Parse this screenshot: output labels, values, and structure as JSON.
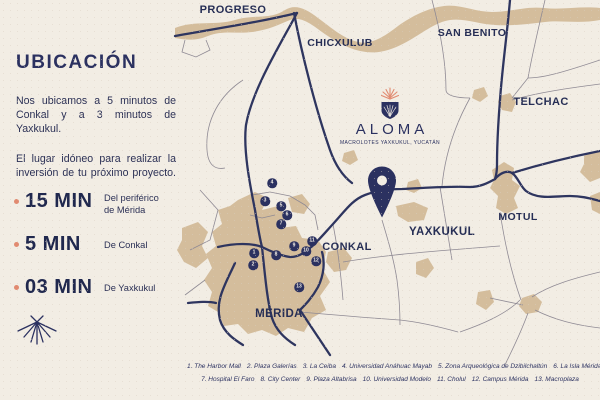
{
  "colors": {
    "background": "#f2ede4",
    "navy": "#2b3160",
    "land_tan": "#d4bd9c",
    "salmon": "#e18a70",
    "thin_road": "#8f8a94"
  },
  "sidebar": {
    "title": "UBICACIÓN",
    "paragraphs": [
      "Nos ubicamos a 5 minutos de Conkal y a 3 minutos de Yaxkukul.",
      "El lugar idóneo para realizar la inversión de tu próximo proyecto."
    ],
    "times": [
      {
        "value": "15 MIN",
        "caption": "Del periférico de Mérida"
      },
      {
        "value": "5 MIN",
        "caption": "De Conkal"
      },
      {
        "value": "03 MIN",
        "caption": "De Yaxkukul"
      }
    ]
  },
  "map": {
    "logo": {
      "name": "ALOMA",
      "tagline": "MACROLOTES YAXKUKUL, YUCATÁN"
    },
    "cities": [
      {
        "name": "PROGRESO",
        "x": 233,
        "y": 10,
        "fs": 11
      },
      {
        "name": "CHICXULUB",
        "x": 340,
        "y": 43,
        "fs": 10.5
      },
      {
        "name": "SAN BENITO",
        "x": 472,
        "y": 33,
        "fs": 10.5
      },
      {
        "name": "TELCHAC",
        "x": 541,
        "y": 102,
        "fs": 11
      },
      {
        "name": "MOTUL",
        "x": 518,
        "y": 217,
        "fs": 10.5
      },
      {
        "name": "CONKAL",
        "x": 347,
        "y": 247,
        "fs": 11
      },
      {
        "name": "YAXKUKUL",
        "x": 442,
        "y": 232,
        "fs": 11.5
      },
      {
        "name": "MÉRIDA",
        "x": 279,
        "y": 314,
        "fs": 11.5
      }
    ],
    "markers": [
      {
        "n": "1",
        "x": 254,
        "y": 253
      },
      {
        "n": "2",
        "x": 253,
        "y": 265
      },
      {
        "n": "3",
        "x": 265,
        "y": 201
      },
      {
        "n": "4",
        "x": 272,
        "y": 183
      },
      {
        "n": "5",
        "x": 281,
        "y": 206
      },
      {
        "n": "6",
        "x": 287,
        "y": 215
      },
      {
        "n": "7",
        "x": 281,
        "y": 224
      },
      {
        "n": "8",
        "x": 276,
        "y": 255
      },
      {
        "n": "9",
        "x": 294,
        "y": 246
      },
      {
        "n": "10",
        "x": 306,
        "y": 251
      },
      {
        "n": "11",
        "x": 312,
        "y": 241
      },
      {
        "n": "12",
        "x": 316,
        "y": 261
      },
      {
        "n": "13",
        "x": 299,
        "y": 287
      }
    ]
  },
  "legend": {
    "rows": [
      [
        "1. The Harbor Mall",
        "2. Plaza Galerías",
        "3. La Ceiba",
        "4. Universidad Anáhuac Mayab",
        "5. Zona Arqueológica de Dzibilchaltún",
        "6. La Isla Mérida"
      ],
      [
        "7. Hospital El Faro",
        "8. City Center",
        "9. Plaza Altabrisa",
        "10. Universidad Modelo",
        "11. Cholul",
        "12. Campus Mérida",
        "13. Macroplaza"
      ]
    ]
  }
}
